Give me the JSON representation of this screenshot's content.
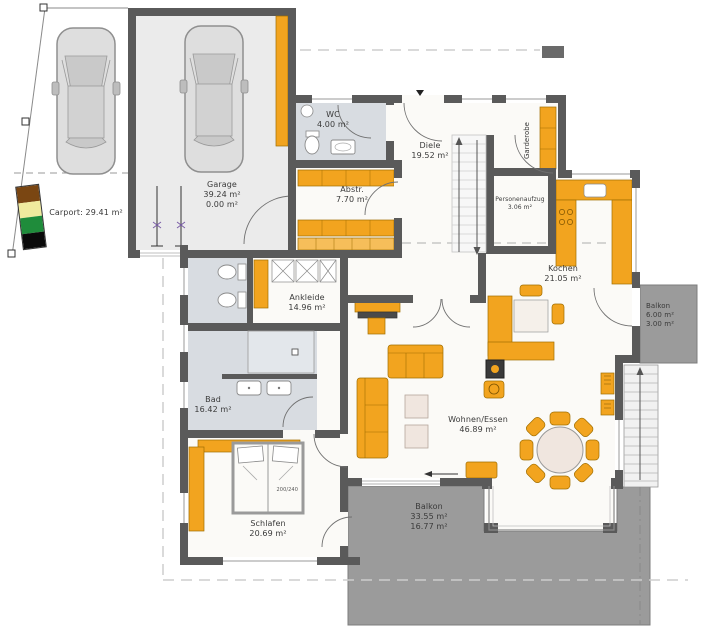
{
  "rooms": {
    "carport": {
      "label": "Carport: 29.41 m²"
    },
    "garage": {
      "name": "Garage",
      "line2": "39.24 m²",
      "line3": "0.00 m²"
    },
    "wc": {
      "name": "WC",
      "line2": "4.00 m²"
    },
    "diele": {
      "name": "Diele",
      "line2": "19.52 m²"
    },
    "garderobe": {
      "name": "Garderobe"
    },
    "personenaufzug": {
      "name": "Personenaufzug",
      "line2": "3.06 m²"
    },
    "abstellraum": {
      "name": "Abstr.",
      "line2": "7.70 m²"
    },
    "kochen": {
      "name": "Kochen",
      "line2": "21.05 m²"
    },
    "balkon_ost": {
      "name": "Balkon",
      "line2": "6.00 m²",
      "line3": "3.00 m²"
    },
    "ankleide": {
      "name": "Ankleide",
      "line2": "14.96 m²"
    },
    "bad": {
      "name": "Bad",
      "line2": "16.42 m²"
    },
    "wohnen_essen": {
      "name": "Wohnen/Essen",
      "line2": "46.89 m²"
    },
    "schlafen": {
      "name": "Schlafen",
      "line2": "20.69 m²"
    },
    "balkon_sued": {
      "name": "Balkon",
      "line2": "33.55 m²",
      "line3": "16.77 m²"
    }
  },
  "furniture": {
    "bed_size": "200/240"
  },
  "colors": {
    "wall": "#5A5A5A",
    "furniture_orange": "#F2A41F",
    "wet_room_floor": "#D8DCE1",
    "garage_floor": "#EBEBEB",
    "balcony": "#9B9B9B",
    "legend_brown": "#7A4612",
    "legend_cream": "#F0EB9E",
    "legend_green": "#1F8C3B",
    "legend_black": "#0A0A0A"
  }
}
